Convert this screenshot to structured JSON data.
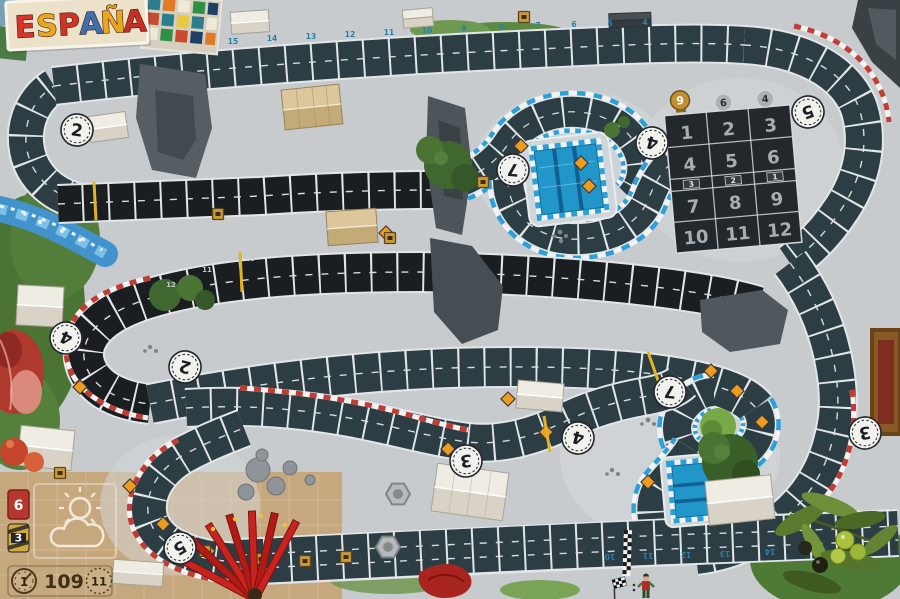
{
  "title": {
    "text": "ESPAÑA",
    "letters": [
      "E",
      "S",
      "P",
      "A",
      "Ñ",
      "A"
    ]
  },
  "corners": [
    "2",
    "7",
    "4",
    "5",
    "4",
    "2",
    "3",
    "4",
    "7",
    "3",
    "5"
  ],
  "starting_grid": {
    "cells": [
      "1",
      "2",
      "3",
      "4",
      "5",
      "6",
      "7",
      "8",
      "9",
      "10",
      "11",
      "12"
    ],
    "lane_markers": [
      "3",
      "2",
      "1"
    ],
    "trophy_value": "9",
    "badge_values": [
      "6",
      "4"
    ]
  },
  "legend": {
    "heat_card": "6",
    "stress_card": "3",
    "gauge_value": "1",
    "track_length": "109",
    "circle_value": "11"
  },
  "space_numbers": {
    "top": [
      "15",
      "14",
      "13",
      "12",
      "11",
      "10",
      "9",
      "8",
      "7",
      "6",
      "5",
      "4"
    ],
    "middle": [
      "12",
      "11",
      "10",
      "9",
      "8",
      "7"
    ],
    "bottom": [
      "10",
      "11",
      "12",
      "13",
      "14"
    ]
  },
  "colors": {
    "track_teal": "#2c3e44",
    "track_black": "#1b1e21",
    "curb_red": "#c23b35",
    "curb_blue": "#2ea0d8",
    "pool_blue": "#2196c9",
    "sign_orange": "#ef9b1d",
    "space_number_blue": "#2e7fa8",
    "panel_tan": "#c6a87f"
  }
}
